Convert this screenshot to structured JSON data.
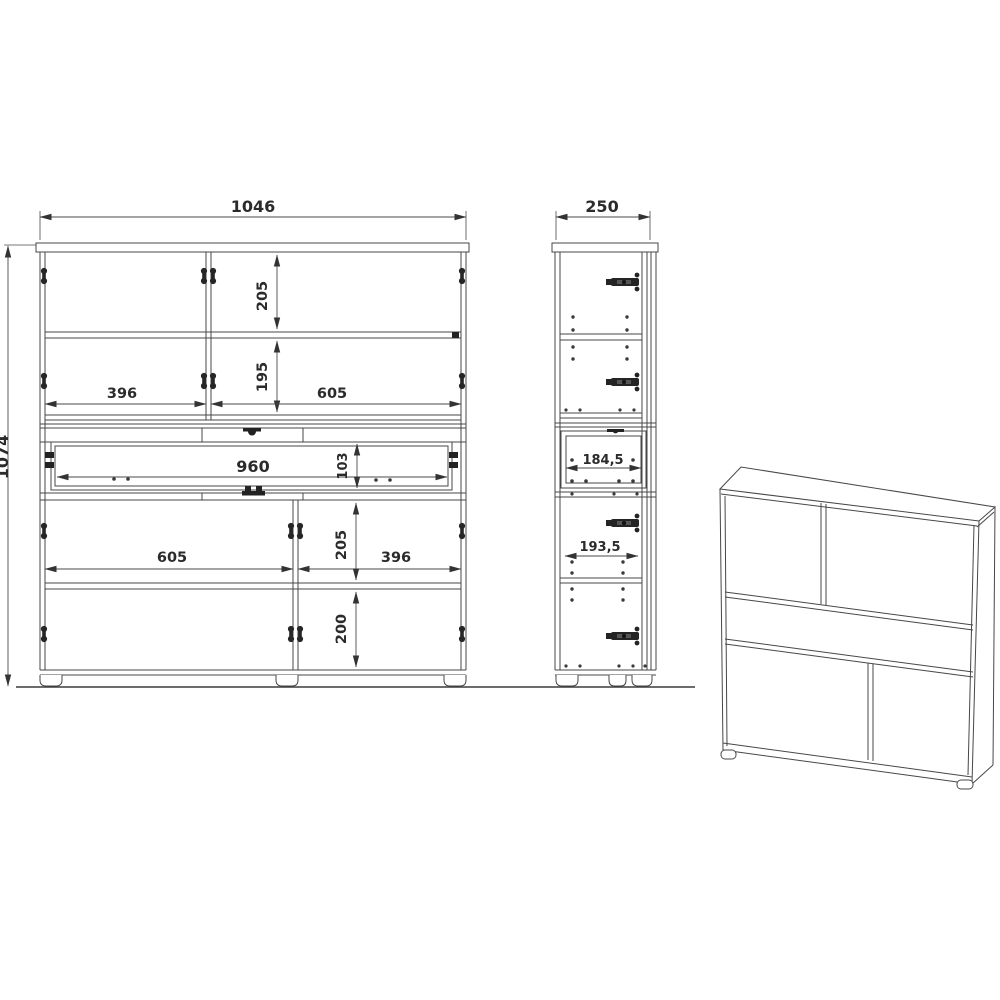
{
  "front_view": {
    "overall_width": "1046",
    "overall_height": "1074",
    "top_section_height": "205",
    "middle_section_height": "195",
    "top_left_width": "396",
    "top_right_width": "605",
    "drawer_width": "960",
    "drawer_height": "103",
    "bottom_left_width": "605",
    "bottom_section_height": "205",
    "bottom_right_width": "396",
    "bottom_lower_height": "200"
  },
  "side_view": {
    "depth": "250",
    "drawer_depth": "184,5",
    "lower_depth": "193,5"
  }
}
